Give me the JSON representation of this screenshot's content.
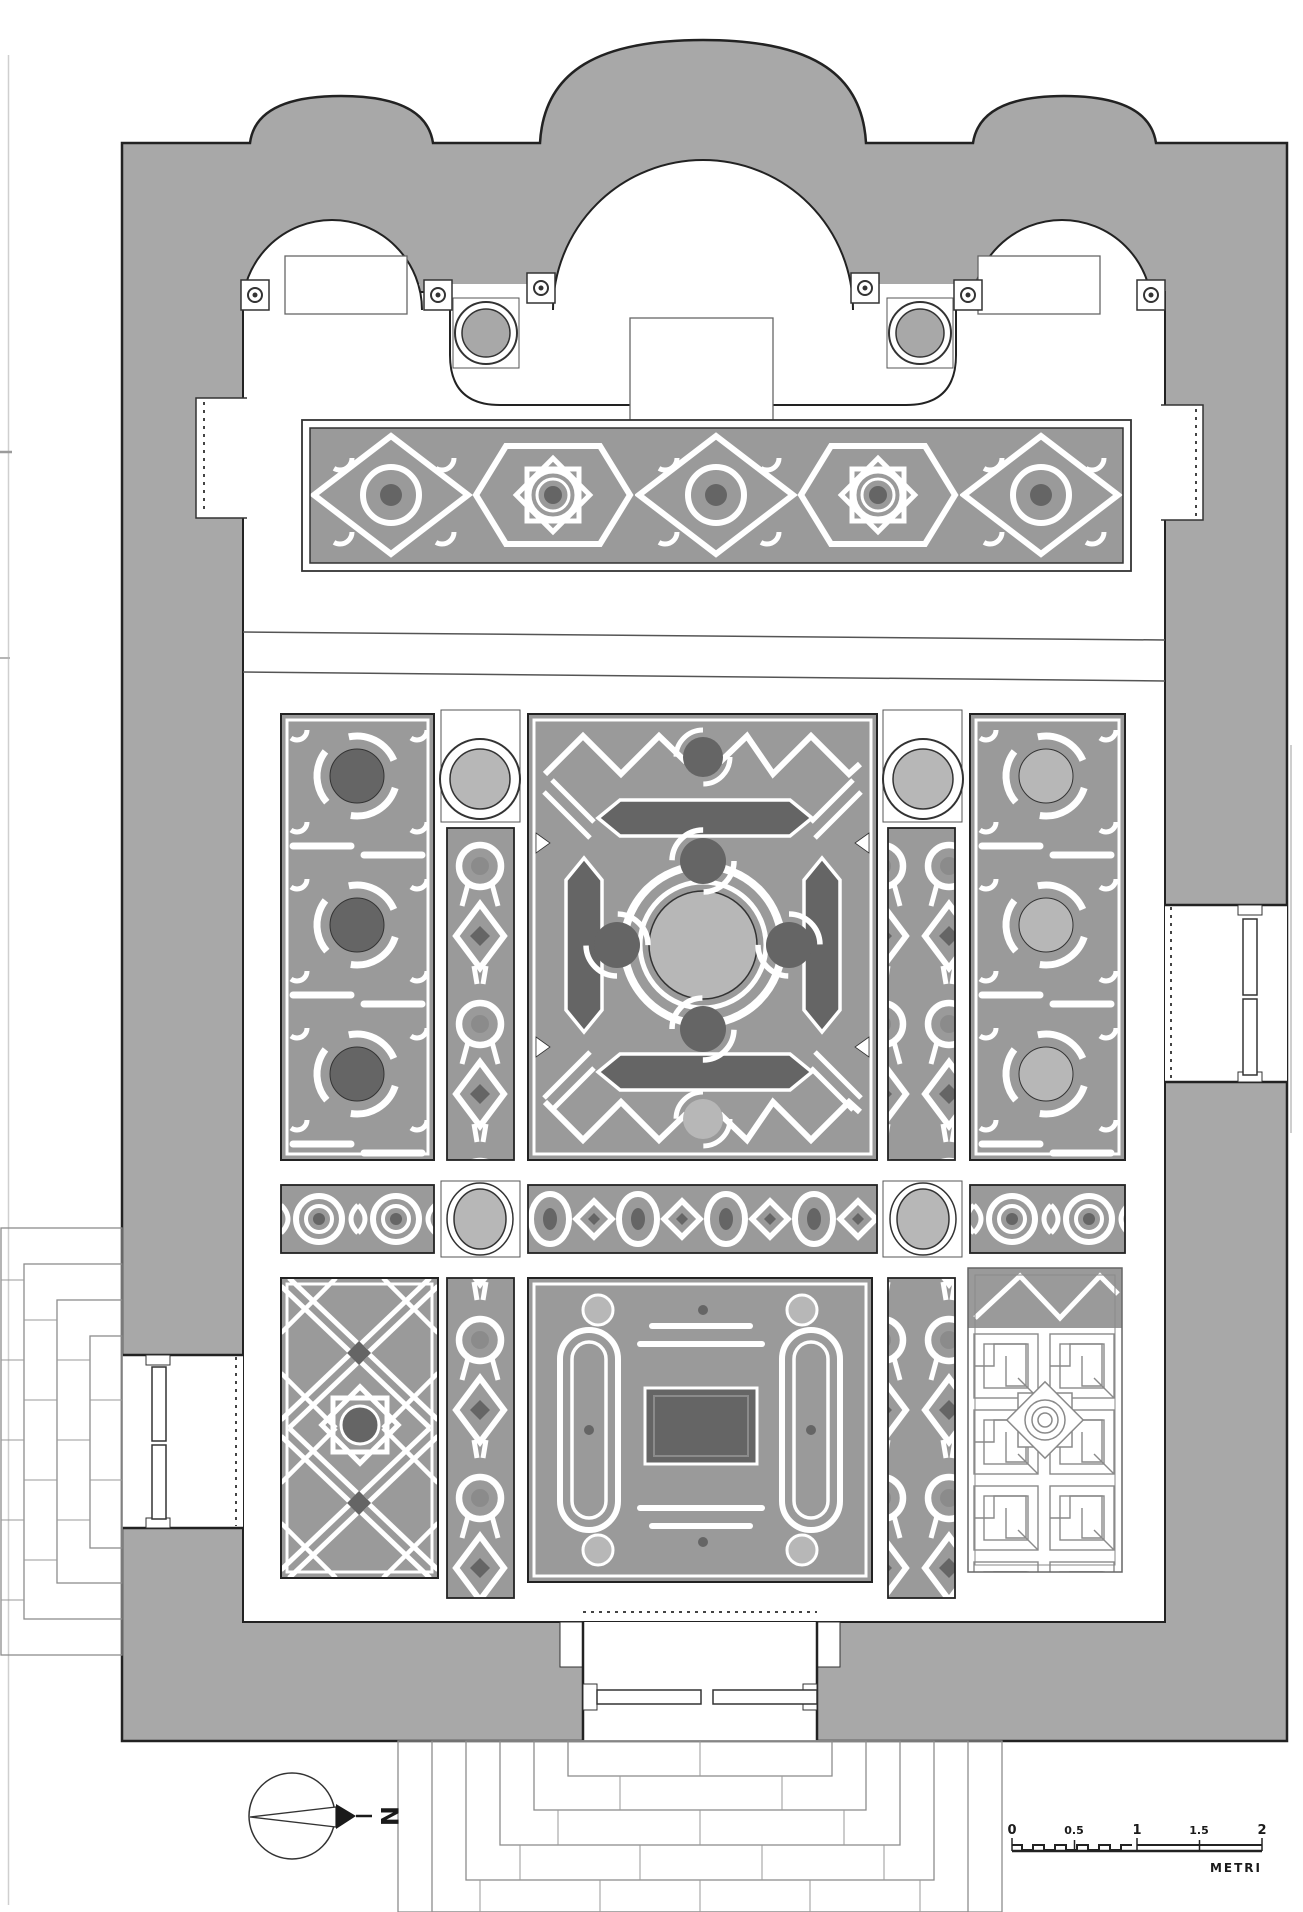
{
  "compass": {
    "north_label": "N"
  },
  "scale_bar": {
    "tick_labels": [
      "0",
      "0.5",
      "1",
      "1.5",
      "2"
    ],
    "unit_label": "METRI"
  },
  "colors": {
    "wall": "#a8a8a8",
    "ground": "#9a9a9a",
    "dark": "#656565",
    "mid": "#8b8b8b",
    "light": "#b7b7b7",
    "ink": "#222222",
    "line": "#8a8a8a"
  }
}
